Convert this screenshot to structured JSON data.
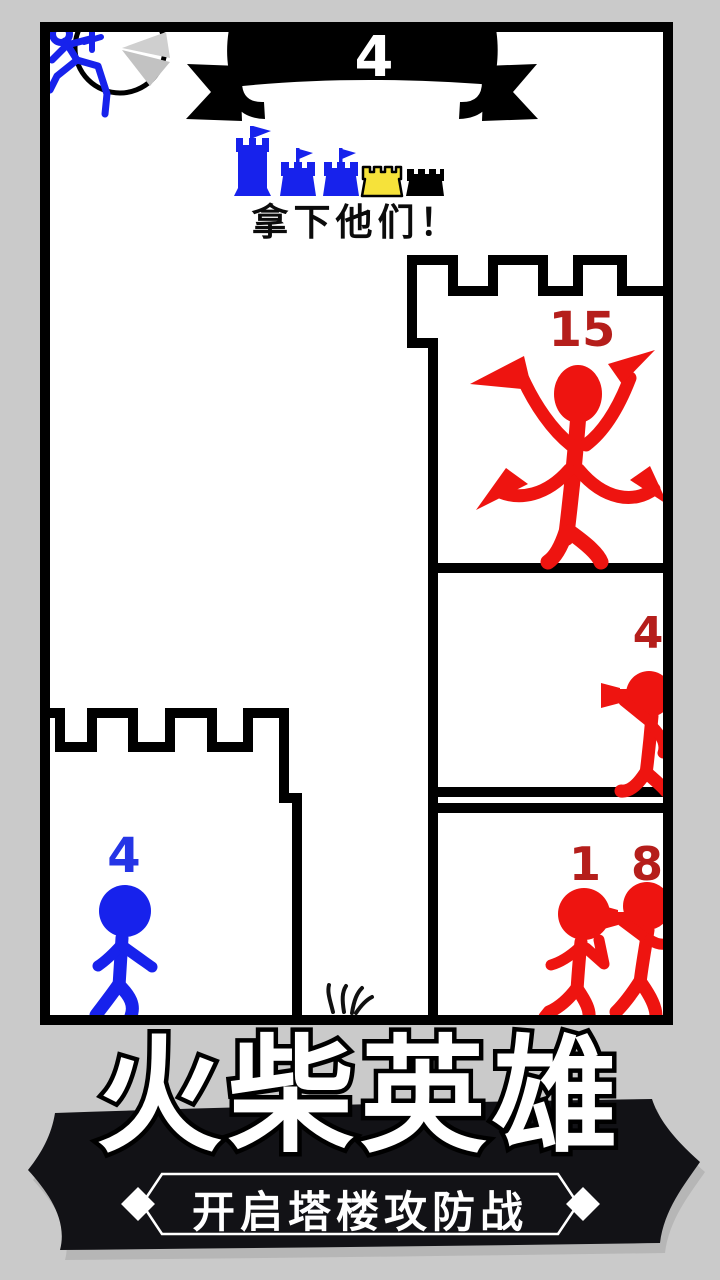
{
  "colors": {
    "background": "#cacaca",
    "player_blue": "#1722ec",
    "player_count_blue": "#2535e6",
    "enemy_red": "#ee1410",
    "enemy_count_red": "#b51e1b",
    "castle_yellow": "#f6e23a",
    "outline_black": "#000000",
    "footer_banner_dark": "#121216",
    "banner_text_white": "#ffffff"
  },
  "top_banner": {
    "count": "4"
  },
  "hud": {
    "instruction": "拿下他们！",
    "castle_icons": [
      {
        "name": "castle-large-blue",
        "color": "blue",
        "flag": true
      },
      {
        "name": "castle-small-blue-1",
        "color": "blue",
        "flag": true
      },
      {
        "name": "castle-small-blue-2",
        "color": "blue",
        "flag": true
      },
      {
        "name": "castle-small-yellow",
        "color": "yellow",
        "flag": false
      },
      {
        "name": "castle-small-black",
        "color": "black",
        "flag": false
      }
    ]
  },
  "enemy_tower": {
    "rooms": [
      {
        "count": "15",
        "unit": "knife-warrior"
      },
      {
        "count": "4",
        "unit": "gunner"
      },
      {
        "count_left": "1",
        "count_right": "8",
        "unit": "brawler-and-gunner"
      }
    ]
  },
  "player_castle": {
    "count": "4",
    "unit": "walker"
  },
  "footer": {
    "title": "火柴英雄",
    "subtitle": "开启塔楼攻防战"
  }
}
